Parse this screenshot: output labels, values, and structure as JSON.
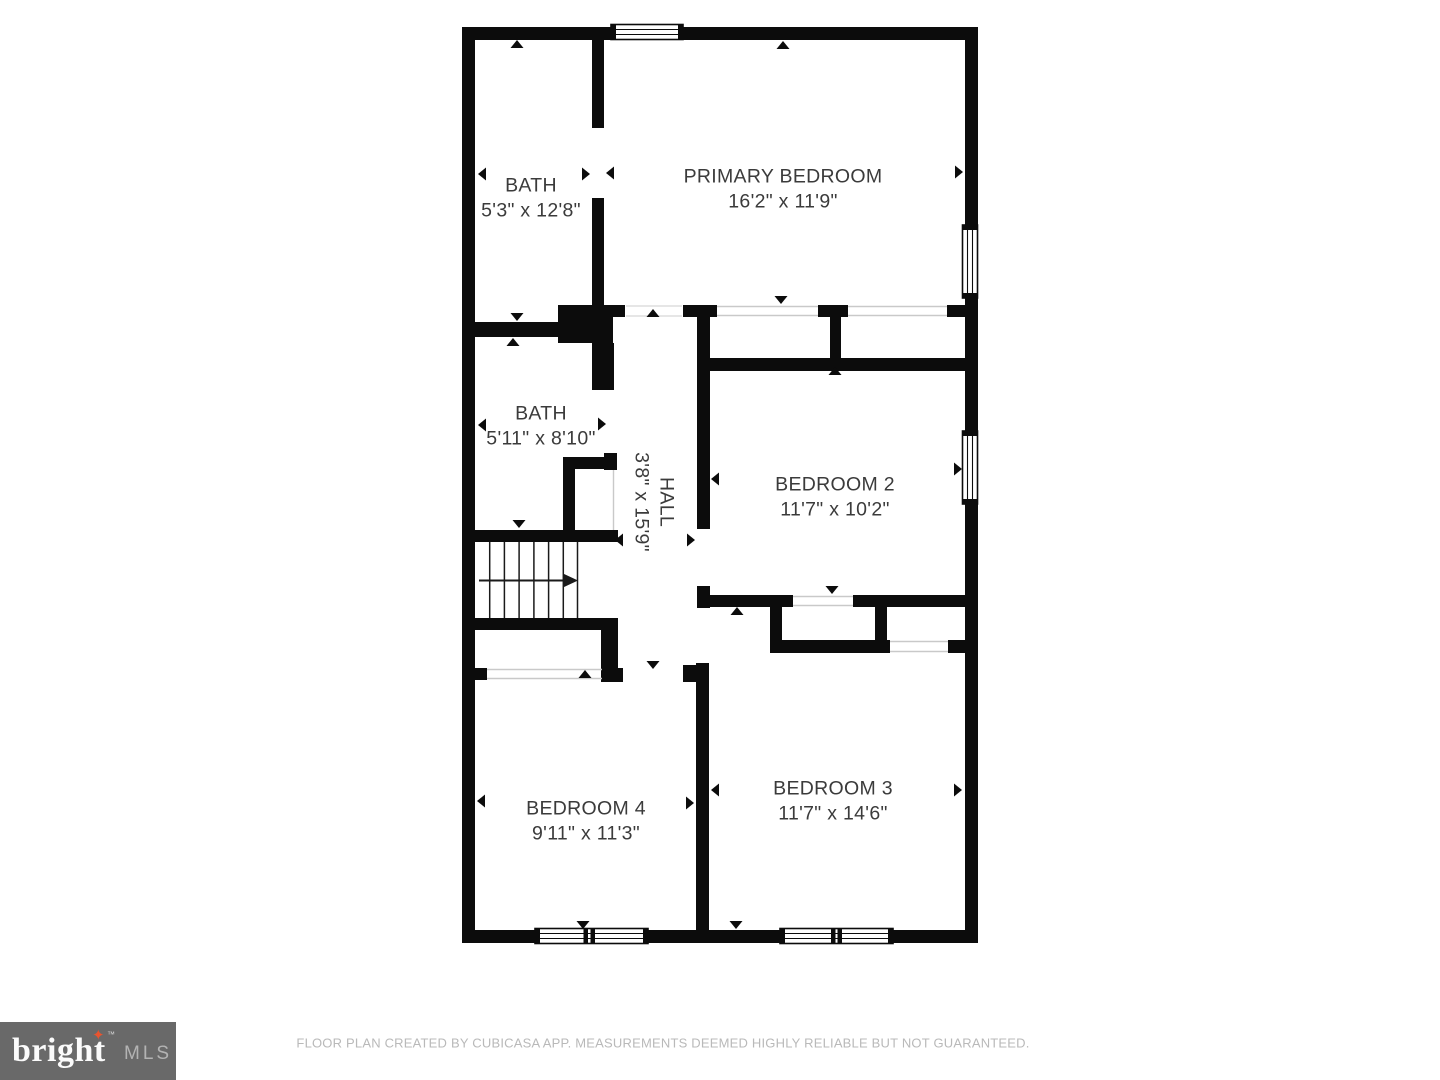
{
  "floor_plan": {
    "rooms": {
      "bath_upper": {
        "name": "BATH",
        "dims": "5'3\" x 12'8\""
      },
      "primary_bedroom": {
        "name": "PRIMARY BEDROOM",
        "dims": "16'2\" x 11'9\""
      },
      "bath_lower": {
        "name": "BATH",
        "dims": "5'11\" x 8'10\""
      },
      "hall": {
        "name": "HALL",
        "dims": "3'8\" x 15'9\""
      },
      "bedroom_2": {
        "name": "BEDROOM 2",
        "dims": "11'7\" x 10'2\""
      },
      "bedroom_4": {
        "name": "BEDROOM 4",
        "dims": "9'11\" x 11'3\""
      },
      "bedroom_3": {
        "name": "BEDROOM 3",
        "dims": "11'7\" x 14'6\""
      }
    }
  },
  "footer": {
    "disclaimer": "FLOOR PLAN CREATED BY CUBICASA APP. MEASUREMENTS DEEMED HIGHLY RELIABLE BUT NOT GUARANTEED."
  },
  "logo": {
    "brand": "bright",
    "star": "✦",
    "tm": "™",
    "mls": "MLS"
  },
  "colors": {
    "wall": "#0c0c0c",
    "label_text": "#3b3b3b",
    "footer_text": "#b9b9b9",
    "logo_bg": "#696969",
    "logo_star": "#e8542f",
    "logo_mls": "#b3b3b3",
    "opening_line": "#c9c9c9"
  }
}
